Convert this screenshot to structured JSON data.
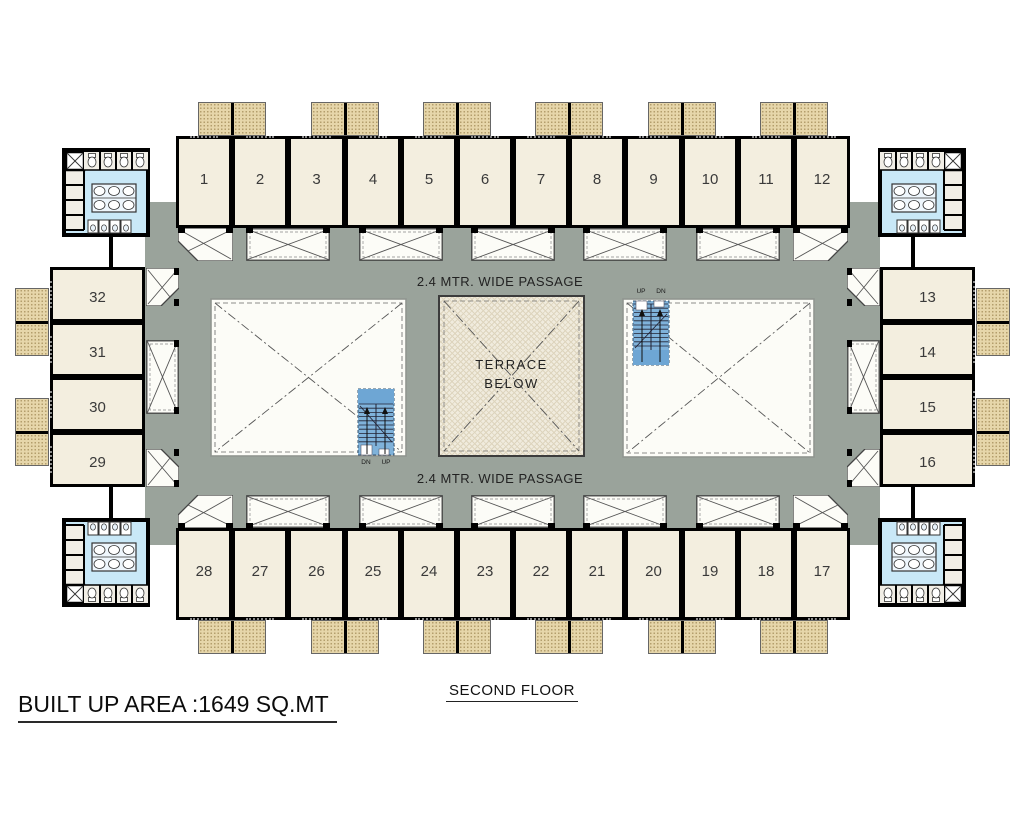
{
  "title": {
    "area_label": "BUILT UP AREA :1649 SQ.MT",
    "floor_label": "SECOND FLOOR"
  },
  "passage": {
    "top_label": "2.4 MTR. WIDE PASSAGE",
    "bottom_label": "2.4 MTR. WIDE PASSAGE"
  },
  "terrace": {
    "label_lines": [
      "TERRACE",
      "BELOW"
    ]
  },
  "stairs": [
    {
      "position": "left-court",
      "labels": [
        "DN",
        "UP"
      ]
    },
    {
      "position": "right-court",
      "labels": [
        "UP",
        "DN"
      ]
    }
  ],
  "rooms": {
    "top": [
      "1",
      "2",
      "3",
      "4",
      "5",
      "6",
      "7",
      "8",
      "9",
      "10",
      "11",
      "12"
    ],
    "bottom_left_to_right": [
      "28",
      "27",
      "26",
      "25",
      "24",
      "23",
      "22",
      "21",
      "20",
      "19",
      "18",
      "17"
    ],
    "left_top_to_bottom": [
      "32",
      "31",
      "30",
      "29"
    ],
    "right_top_to_bottom": [
      "13",
      "14",
      "15",
      "16"
    ]
  },
  "colors": {
    "passage_gray": "#9aa39b",
    "room_fill": "#f3eedf",
    "balcony_tan": "#e6d6aa",
    "terrace_fill": "#f0ebdd",
    "toilet_floor_blue": "#c9e8f7",
    "stair_blue": "#7fb2da",
    "wall_black": "#000000",
    "canopy_white": "#fcfcf7"
  }
}
